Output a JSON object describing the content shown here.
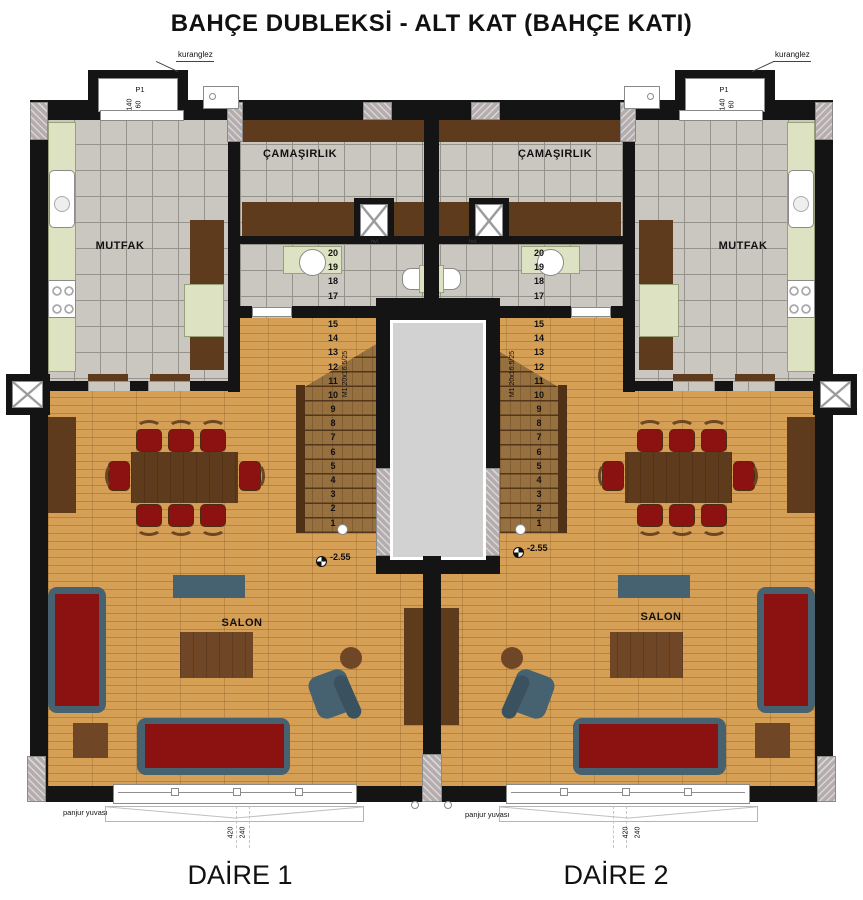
{
  "title": "BAHÇE DUBLEKSİ - ALT KAT (BAHÇE KATI)",
  "apartments": [
    {
      "name": "DAİRE 1"
    },
    {
      "name": "DAİRE 2"
    }
  ],
  "rooms": {
    "kitchen": "MUTFAK",
    "laundry": "ÇAMAŞIRLIK",
    "living": "SALON",
    "wc_tag": "hvl."
  },
  "stairs": {
    "label": "M1 20x16.5/25",
    "steps": [
      "20",
      "19",
      "18",
      "17",
      "16",
      "15",
      "14",
      "13",
      "12",
      "11",
      "10",
      "9",
      "8",
      "7",
      "6",
      "5",
      "4",
      "3",
      "2",
      "1"
    ]
  },
  "window": {
    "tag": "P1",
    "width": "140",
    "height": "60",
    "note": "kuranglez"
  },
  "shutter": {
    "label": "panjur yuvası",
    "width": "420",
    "height": "240"
  },
  "level": {
    "value": "-2.55"
  },
  "palette": {
    "wall": "#141414",
    "wood_floor": "#d5a055",
    "tile_floor": "#c9c7c0",
    "counter_green": "#dde3c2",
    "sofa_red": "#8c1111",
    "frame_slate": "#46616f",
    "cabinet_brown": "#5f3b1d",
    "stair_tread": "#96703f",
    "shaft_gray": "#d2d2d2"
  }
}
